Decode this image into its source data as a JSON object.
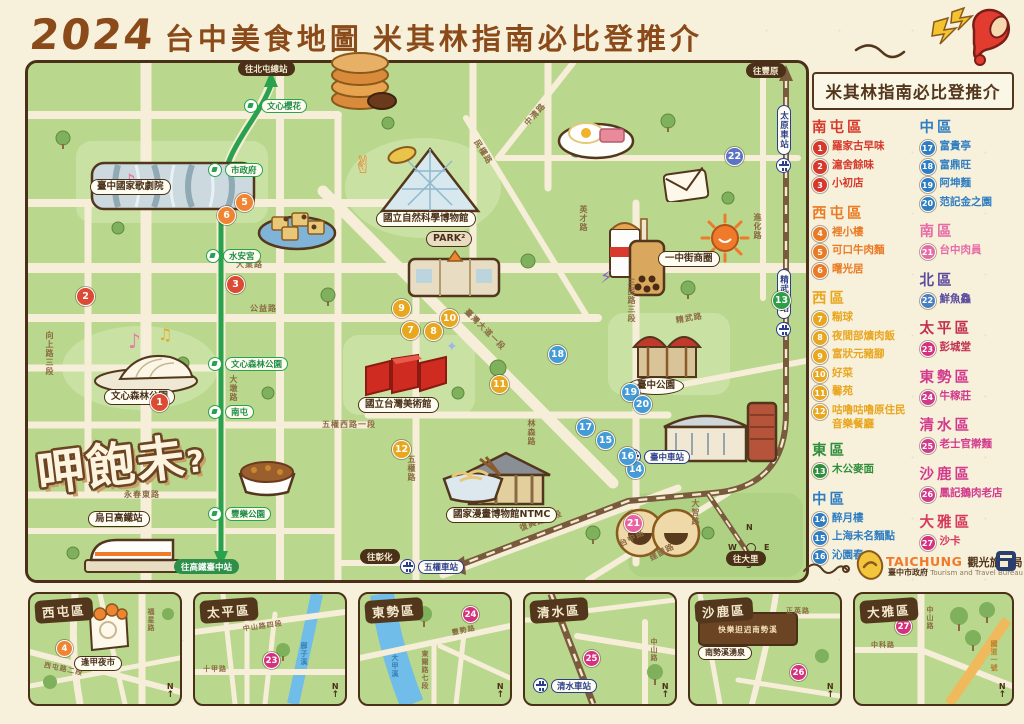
{
  "title": {
    "year": "2024",
    "main": "台中美食地圖",
    "sub": "米其林指南必比登推介"
  },
  "promo": {
    "header": "米其林指南必比登推介"
  },
  "legend": {
    "columns": [
      {
        "sections": [
          {
            "district": "南屯區",
            "color": "#d6392b",
            "items": [
              {
                "n": "1",
                "name": "羅家古早味"
              },
              {
                "n": "2",
                "name": "滬舍餘味"
              },
              {
                "n": "3",
                "name": "小初店"
              }
            ]
          },
          {
            "district": "西屯區",
            "color": "#ea7a24",
            "items": [
              {
                "n": "4",
                "name": "裡小樓"
              },
              {
                "n": "5",
                "name": "可口牛肉麵"
              },
              {
                "n": "6",
                "name": "曙光居"
              }
            ]
          },
          {
            "district": "西區",
            "color": "#e9a61f",
            "items": [
              {
                "n": "7",
                "name": "糋球"
              },
              {
                "n": "8",
                "name": "夜間部爌肉飯"
              },
              {
                "n": "9",
                "name": "富狀元豬腳"
              },
              {
                "n": "10",
                "name": "好菜"
              },
              {
                "n": "11",
                "name": "馨苑"
              },
              {
                "n": "12",
                "name": "咕嚕咕嚕原住民音樂餐廳"
              }
            ]
          },
          {
            "district": "東區",
            "color": "#2f8f3c",
            "items": [
              {
                "n": "13",
                "name": "木公麥面"
              }
            ]
          },
          {
            "district": "中區",
            "color": "#2f7ec2",
            "items": [
              {
                "n": "14",
                "name": "醉月樓"
              },
              {
                "n": "15",
                "name": "上海未名麵點"
              },
              {
                "n": "16",
                "name": "沁園春"
              }
            ]
          }
        ]
      },
      {
        "sections": [
          {
            "district": "中區",
            "color": "#2f7ec2",
            "items": [
              {
                "n": "17",
                "name": "富貴亭"
              },
              {
                "n": "18",
                "name": "富鼎旺"
              },
              {
                "n": "19",
                "name": "阿坤麵"
              },
              {
                "n": "20",
                "name": "范記金之園"
              }
            ]
          },
          {
            "district": "南區",
            "color": "#e66ba6",
            "items": [
              {
                "n": "21",
                "name": "台中肉員"
              }
            ]
          },
          {
            "district": "北區",
            "color": "#5a4b9e",
            "items": [
              {
                "n": "22",
                "name": "鮮魚鱻"
              }
            ]
          },
          {
            "district": "太平區",
            "color": "#c13050",
            "items": [
              {
                "n": "23",
                "name": "彭城堂"
              }
            ]
          },
          {
            "district": "東勢區",
            "color": "#d23a8c",
            "items": [
              {
                "n": "24",
                "name": "牛稼莊"
              }
            ]
          },
          {
            "district": "清水區",
            "color": "#d23a8c",
            "items": [
              {
                "n": "25",
                "name": "老士官擀麵"
              }
            ]
          },
          {
            "district": "沙鹿區",
            "color": "#d23a8c",
            "items": [
              {
                "n": "26",
                "name": "鳳記鵝肉老店"
              }
            ]
          },
          {
            "district": "大雅區",
            "color": "#d6395c",
            "items": [
              {
                "n": "27",
                "name": "沙卡"
              }
            ]
          }
        ]
      }
    ]
  },
  "map": {
    "logo": {
      "text": "呷飽未",
      "mark": "?"
    },
    "mrt": {
      "stations": [
        "文心櫻花",
        "市政府",
        "水安宮",
        "文心森林公園",
        "南屯",
        "豐樂公園"
      ],
      "to_north": "往北屯總站",
      "to_south": "往高鐵臺中站"
    },
    "rail": {
      "stations": [
        "太原車站",
        "精武車站",
        "臺中車站",
        "五權車站"
      ],
      "to_north": "往豐原",
      "to_west": "往彰化",
      "to_south": "往大里"
    },
    "landmarks": [
      "臺中國家歌劇院",
      "國立自然科學博物館",
      "PARK²",
      "國立台灣美術館",
      "國家漫畫博物館NTMC",
      "臺中公園",
      "一中街商圈",
      "文心森林公園",
      "烏日高鐵站"
    ],
    "roads": [
      "公益路",
      "大業路",
      "向上路三段",
      "大墩路",
      "永春東路",
      "民權路",
      "中清路",
      "臺灣大道一段",
      "英才路",
      "三民路三段",
      "五權路",
      "五權西路一段",
      "林森路",
      "進化路",
      "精武路",
      "復興路三段",
      "台中路",
      "建國路",
      "大智路"
    ],
    "markers": [
      "1",
      "2",
      "3",
      "5",
      "6",
      "7",
      "8",
      "9",
      "10",
      "11",
      "12",
      "13",
      "14",
      "15",
      "16",
      "17",
      "18",
      "19",
      "20",
      "21",
      "22"
    ],
    "compass": {
      "n": "N",
      "e": "E",
      "s": "S",
      "w": "W"
    }
  },
  "insets": [
    {
      "district": "西屯區",
      "marker": "4",
      "landmark": "逢甲夜市",
      "roads": [
        "福星路",
        "西屯路二段"
      ]
    },
    {
      "district": "太平區",
      "marker": "23",
      "river": "廍子溪",
      "roads": [
        "十甲路",
        "中山路四段"
      ]
    },
    {
      "district": "東勢區",
      "marker": "24",
      "river": "大甲溪",
      "roads": [
        "豐勢路",
        "東關路七段"
      ]
    },
    {
      "district": "清水區",
      "marker": "25",
      "station": "清水車站",
      "roads": [
        "中山路"
      ]
    },
    {
      "district": "沙鹿區",
      "marker": "26",
      "gate": "快樂𨑨迌南勢溪",
      "spot": "南勢溪湧泉",
      "roads": [
        "正英路"
      ]
    },
    {
      "district": "大雅區",
      "marker": "27",
      "roads": [
        "中山路",
        "中科路",
        "國道一號"
      ]
    }
  ],
  "footer": {
    "brand": "TAICHUNG",
    "bureau": "觀光旅遊局",
    "gov": "臺中市政府",
    "gov_en": "Tourism and Travel Bureau"
  }
}
